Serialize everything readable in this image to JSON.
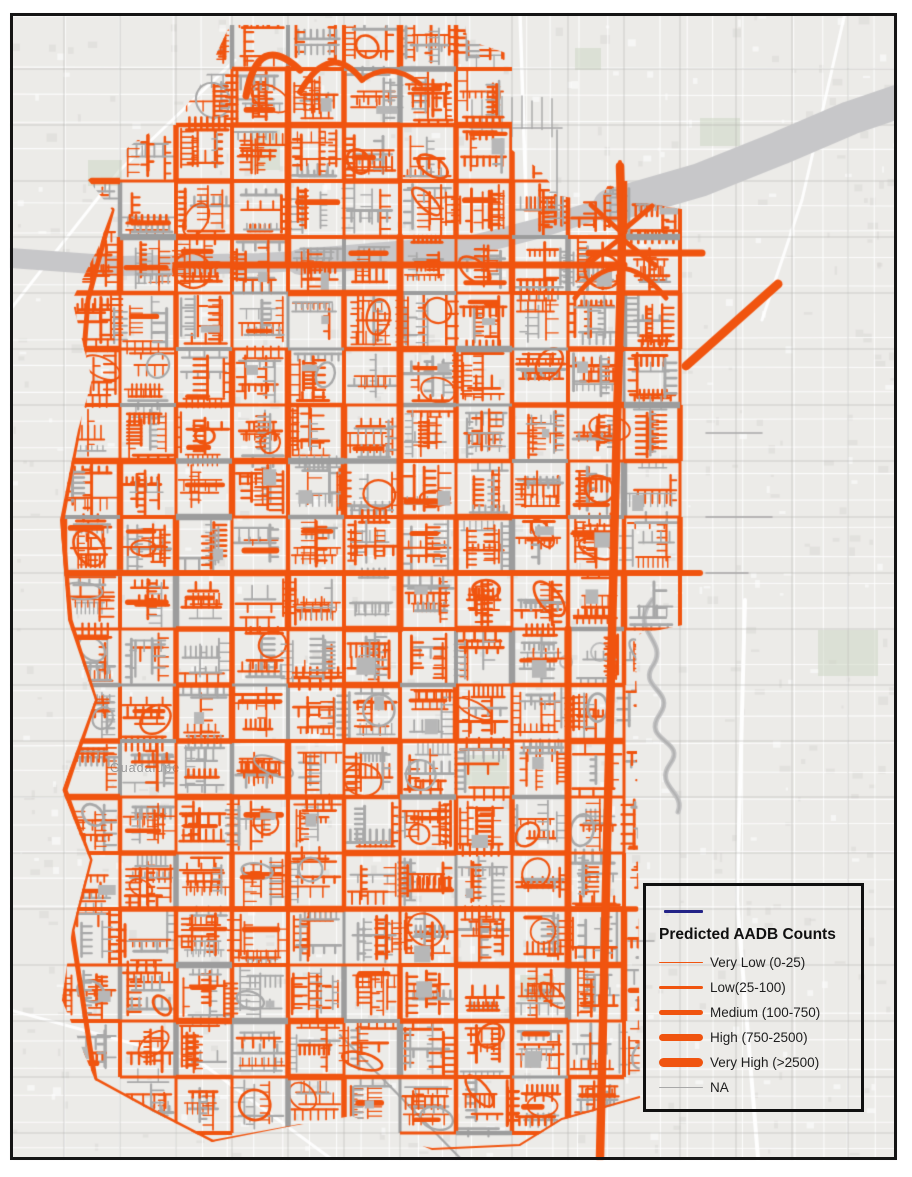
{
  "map": {
    "place_label": "Guadalupe",
    "colors": {
      "network_orange": "#F0540F",
      "road_gray": "#A8A8A8",
      "arterial_gray": "#9C9C9C",
      "basemap": "#ECEBE8",
      "river_gray": "#C7C7C9",
      "creek_gray": "#B7B7B8",
      "frame_black": "#151515"
    }
  },
  "legend": {
    "boundary_swatch_color": "#232387",
    "title": "Predicted AADB Counts",
    "items": [
      {
        "label": "Very Low (0-25)",
        "color": "#F0540F",
        "weight": 1
      },
      {
        "label": "Low(25-100)",
        "color": "#F0540F",
        "weight": 3.5
      },
      {
        "label": "Medium (100-750)",
        "color": "#F0540F",
        "weight": 5
      },
      {
        "label": "High (750-2500)",
        "color": "#F0540F",
        "weight": 7
      },
      {
        "label": "Very High (>2500)",
        "color": "#F0540F",
        "weight": 9
      },
      {
        "label": "NA",
        "color": "#A8A8A8",
        "weight": 1.5
      }
    ]
  }
}
